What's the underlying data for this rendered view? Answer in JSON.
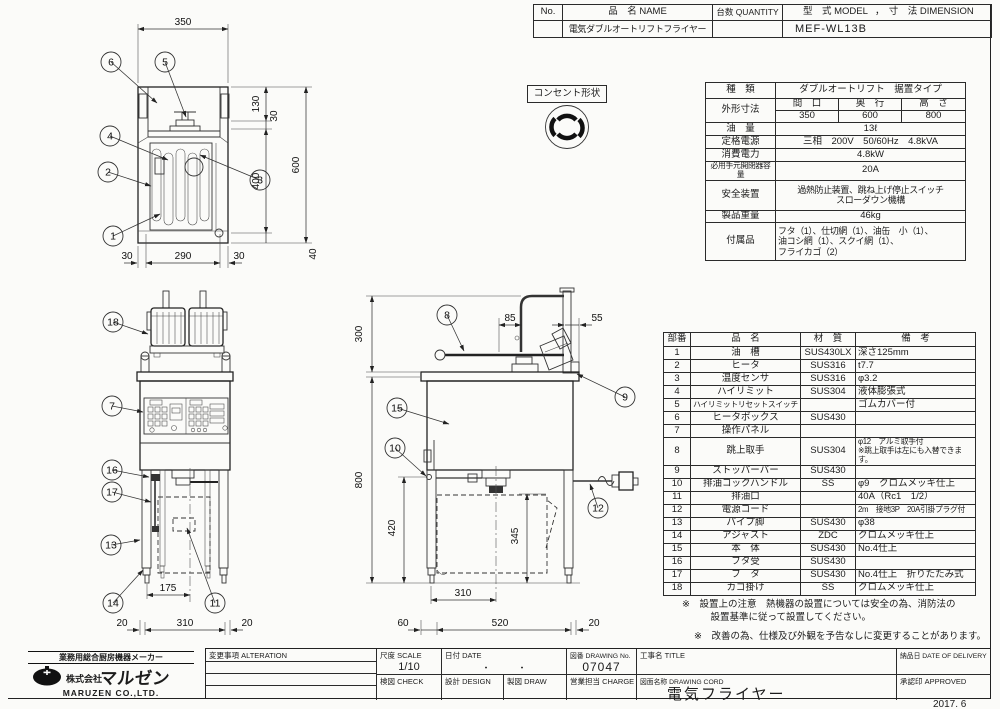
{
  "header_table": {
    "col_no": "No.",
    "col_name": "品　名 NAME",
    "col_qty": "台数 QUANTITY",
    "col_model": "型　式 MODEL",
    "col_sep": "，",
    "col_dim": "寸　法 DIMENSION",
    "name_value": "電気ダブルオートリフトフライヤー",
    "model_value": "MEF-WL13B"
  },
  "outlet": {
    "label": "コンセント形状"
  },
  "spec_table": {
    "kind_label": "種　類",
    "kind_value": "ダブルオートリフト　据置タイプ",
    "dims_label": "外形寸法",
    "width_label": "間　口",
    "depth_label": "奥　行",
    "height_label": "高　さ",
    "width_value": "350",
    "depth_value": "600",
    "height_value": "800",
    "oil_label": "油　量",
    "oil_value": "13ℓ",
    "power_label": "定格電源",
    "power_value": "三相　200V　50/60Hz　4.8kVA",
    "consumption_label": "消費電力",
    "consumption_value": "4.8kW",
    "breaker_label": "必用手元開閉器容量",
    "breaker_value": "20A",
    "safety_label": "安全装置",
    "safety_value": "過熱防止装置、跳ね上げ停止スイッチ\nスローダウン機構",
    "weight_label": "製品重量",
    "weight_value": "46kg",
    "accessories_label": "付属品",
    "accessories_value": "フタ（1）、仕切網（1）、油缶　小（1）、\n油コシ網（1）、スクイ網（1）、\nフライカゴ（2）"
  },
  "parts_table": {
    "headers": [
      "部番",
      "品　名",
      "材　質",
      "備　考"
    ],
    "rows": [
      [
        "1",
        "油　槽",
        "SUS430LX",
        "深さ125mm"
      ],
      [
        "2",
        "ヒータ",
        "SUS316",
        "t7.7"
      ],
      [
        "3",
        "温度センサ",
        "SUS316",
        "φ3.2"
      ],
      [
        "4",
        "ハイリミット",
        "SUS304",
        "液体膨張式"
      ],
      [
        "5",
        "ハイリミットリセットスイッチ",
        "",
        "ゴムカバー付"
      ],
      [
        "6",
        "ヒータボックス",
        "SUS430",
        ""
      ],
      [
        "7",
        "操作パネル",
        "",
        ""
      ],
      [
        "8",
        "跳上取手",
        "SUS304",
        "φ12　アルミ取手付\n※跳上取手は左にも入替できます。"
      ],
      [
        "9",
        "ストッパーバー",
        "SUS430",
        ""
      ],
      [
        "10",
        "排油コックハンドル",
        "SS",
        "φ9　クロムメッキ仕上"
      ],
      [
        "11",
        "排油口",
        "",
        "40A（Rc1　1/2）"
      ],
      [
        "12",
        "電源コード",
        "",
        "2m　接地3P　20A引掛プラグ付"
      ],
      [
        "13",
        "パイプ脚",
        "SUS430",
        "φ38"
      ],
      [
        "14",
        "アジャスト",
        "ZDC",
        "クロムメッキ仕上"
      ],
      [
        "15",
        "本　体",
        "SUS430",
        "No.4仕上"
      ],
      [
        "16",
        "フタ受",
        "SUS430",
        ""
      ],
      [
        "17",
        "フ　タ",
        "SUS430",
        "No.4仕上　折りたたみ式"
      ],
      [
        "18",
        "カゴ掛け",
        "SS",
        "クロムメッキ仕上"
      ]
    ]
  },
  "notes": {
    "note1": "※　設置上の注意　熱機器の設置については安全の為、消防法の\n　　　設置基準に従って設置してください。",
    "note2": "※　改善の為、仕様及び外観を予告なしに変更することがあります。"
  },
  "title_block": {
    "alteration": "変更事項  ALTERATION",
    "scale_label": "尺度  SCALE",
    "scale_value": "1/10",
    "date_label": "日付  DATE",
    "date_value": "・　　　・",
    "drawing_no_label": "図番  DRAWING No.",
    "drawing_no_value": "07047",
    "title_label": "工事名  TITLE",
    "delivery_label": "納品日  DATE OF DELIVERY",
    "check_label": "検図  CHECK",
    "design_label": "設計  DESIGN",
    "draw_label": "製図  DRAW",
    "charge_label": "営業担当  CHARGE",
    "drawing_name_label": "図面名称  DRAWING CORD",
    "drawing_name_value": "電気フライヤー",
    "approved_label": "承認印  APPROVED"
  },
  "company": {
    "tagline": "業務用総合厨房機器メーカー",
    "prefix": "株式会社",
    "name": "マルゼン",
    "name_en": "MARUZEN  CO.,LTD."
  },
  "revision_date": "2017. 6",
  "balloons": {
    "n1": "1",
    "n2": "2",
    "n3": "3",
    "n4": "4",
    "n5": "5",
    "n6": "6",
    "n7": "7",
    "n8": "8",
    "n9": "9",
    "n10": "10",
    "n11": "11",
    "n12": "12",
    "n13": "13",
    "n14": "14",
    "n15": "15",
    "n16": "16",
    "n17": "17",
    "n18": "18"
  },
  "dims": {
    "t350": "350",
    "t130": "130",
    "t30a": "30",
    "t400": "400",
    "t600": "600",
    "t40": "40",
    "t30b": "30",
    "t290": "290",
    "t30c": "30",
    "f175": "175",
    "f20a": "20",
    "f310": "310",
    "f20b": "20",
    "s300": "300",
    "s85": "85",
    "s55": "55",
    "s800": "800",
    "s420": "420",
    "s345": "345",
    "s310": "310",
    "s60": "60",
    "s520": "520",
    "s20": "20"
  }
}
